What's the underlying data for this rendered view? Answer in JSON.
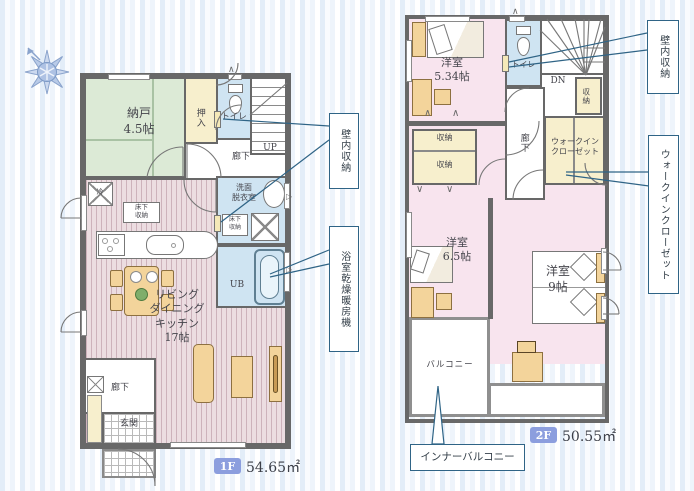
{
  "colors": {
    "badge_bg": "#8c9ede",
    "callout_border": "#2f6486",
    "wall": "#686868"
  },
  "icons": {
    "vent_right": "▷",
    "fold_up": "∧",
    "fold_down": "∨"
  },
  "floor1": {
    "badge": "1F",
    "area": "54.65㎡",
    "rooms": {
      "nando": "納戸\n4.5帖",
      "oshiire": "押入",
      "toilet": "トイレ",
      "stairs": "UP",
      "hall_upper": "廊下",
      "washroom": "洗面\n脱衣室",
      "underfloor_wash": "床下\n収納",
      "bath": "UB",
      "fridge": "冷",
      "underfloor_kitchen": "床下\n収納",
      "ldk": "リビング\nダイニング\nキッチン\n17帖",
      "hall_lower": "廊下",
      "genkan": "玄関"
    },
    "callouts": {
      "wall_storage": "壁内収納",
      "bath_dryer": "浴室乾燥暖房機"
    }
  },
  "floor2": {
    "badge": "2F",
    "area": "50.55㎡",
    "rooms": {
      "bedroom_a": "洋室\n5.34帖",
      "toilet": "トイレ",
      "stairs": "DN",
      "stair_closet": "収納",
      "hall": "廊下",
      "wic": "ウォークイン\nクローゼット",
      "closet_a": "収納",
      "closet_b": "収納",
      "bedroom_b": "洋室\n6.5帖",
      "bedroom_c": "洋室\n9帖",
      "balcony": "バルコニー"
    },
    "callouts": {
      "wall_storage": "壁内収納",
      "wic": "ウォークインクローゼット",
      "inner_balcony": "インナーバルコニー"
    }
  }
}
